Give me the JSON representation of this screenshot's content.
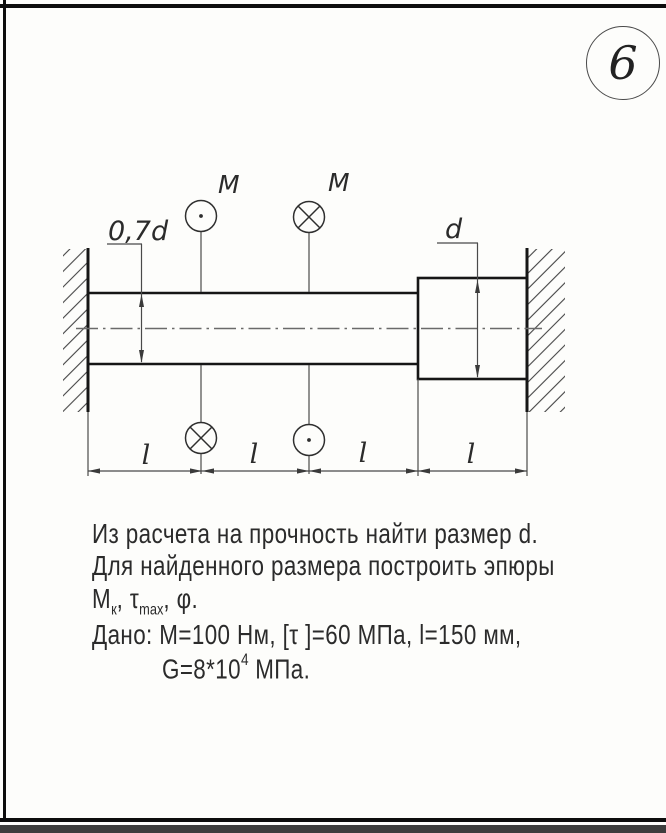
{
  "page": {
    "variant_number": "6",
    "border_color": "#0d0d0d",
    "footer_band_color": "#3d3d3d",
    "paper_color": "#fdfdfb",
    "ink_color": "#2b2b2b"
  },
  "diagram": {
    "moment_label_top_left": "M",
    "moment_label_top_right": "M",
    "dim_small_diameter": "0,7d",
    "dim_large_diameter": "d",
    "len_labels": [
      "l",
      "l",
      "l",
      "l"
    ],
    "symbols": {
      "top_left_circle": "dot-out-of-plane",
      "top_right_circle": "cross-into-plane",
      "bottom_left_circle": "cross-into-plane",
      "bottom_right_circle": "dot-out-of-plane"
    }
  },
  "problem": {
    "line1": "Из расчета на прочность найти размер d.",
    "line2": "Для найденного размера построить эпюры",
    "line3": {
      "m": "M",
      "m_sub": "к",
      "sep1": ", ",
      "tau": "τ",
      "tau_sub": "max",
      "sep2": ", ",
      "phi": "φ."
    },
    "line4": "Дано: M=100 Нм, [τ ]=60 МПа, l=150 мм,",
    "line5": {
      "base": "G=8*10",
      "sup": "4",
      "unit": " МПа."
    }
  }
}
